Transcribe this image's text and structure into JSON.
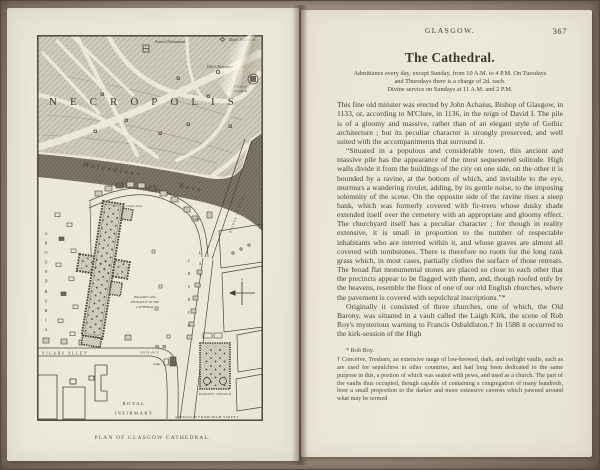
{
  "palette": {
    "backdrop": "#a29385",
    "page_cream": "#ebe7d8",
    "ink": "#45423a",
    "map_ink": "#4a463c",
    "burn_dark": "#7b7668"
  },
  "left_page": {
    "map": {
      "caption": "PLAN OF GLASGOW CATHEDRAL.",
      "necropolis": "NECROPOLIS",
      "burn_word1": "Molendinar",
      "burn_word2": "Burn",
      "knox_monument": "Knox's Monument",
      "black_monument": "Black's Monument",
      "dyke_monument": "Dyke's Monument",
      "mcgavin_line1": "M'Gavin's",
      "mcgavin_line2": "Monument",
      "bridge": "BRIDGE OF SIGHS",
      "church": "CHURCH",
      "lane": "LANE",
      "burial_word": "GROUND",
      "ground_word": "BURIAL",
      "vicars_alley": "VICARS ALLEY",
      "entrance": "ENTRANCE",
      "lodge1": "Lodge",
      "lodge2": "Lodge",
      "chapter_house": "Chapter house",
      "aisle_line1": "Blackadder's Aisle",
      "aisle_line2": "ENTRANCE TO THE",
      "aisle_line3": "CATHEDRAL",
      "royal1": "ROYAL",
      "royal2": "INFIRMARY",
      "barony": "BARONY CHURCH",
      "approach": "APPROACH FROM HIGH STREET",
      "compass_n": "N"
    }
  },
  "right_page": {
    "running_title": "GLASGOW.",
    "page_number": "367",
    "title": "The Cathedral.",
    "notice": [
      "Admittance every day, except Sunday, from 10 A.M. to 4 P.M.  On Tuesdays",
      "and Thursdays there is a charge of 2d. each.",
      "Divine service on Sundays at 11 A.M. and 2 P.M."
    ],
    "paragraphs": [
      "This fine old minster was erected by John Achaius, Bishop of Glasgow, in 1133, or, according to M'Clure, in 1136, in the reign of David I.  The pile is of a gloomy and massive, rather than of an elegant style of Gothic architecture ; but its peculiar character is strongly preserved, and well suited with the accompaniments that surround it.",
      "“Situated in a populous and considerable town, this ancient and massive pile has the appearance of the most sequestered solitude.  High walls divide it from the buildings of the city on one side, on the other it is bounded by a ravine, at the bottom of which, and invisible to the eye, murmurs a wandering rivulet, adding, by its gentle noise, to the imposing solemnity of the scene.  On the opposite side of the ravine rises a steep bank, which was formerly covered with fir-trees whose dusky shade extended itself over the cemetery with an appropriate and gloomy effect.  The churchyard itself has a peculiar character ; for though in reality extensive, it is small in proportion to the number of respectable inhabitants who are interred within it, and whose graves are almost all covered with tombstones.  There is therefore no room for the long rank grass which, in most cases, partially clothes the surface of those retreats.  The broad flat monumental stones are placed so close to each other that the precincts appear to be flagged with them, and, though roofed only by the heavens, resemble the floor of one of our old English churches, where the pavement is covered with sepulchral inscriptions.”*",
      "Originally it consisted of three churches, one of which, the Old Barony, was situated in a vault called the Laigh Kirk, the scene of Rob Roy's mysterious warning to Francis Osbaldiston.†  In 1588 it occurred to the kirk-session of the High"
    ],
    "footnotes": [
      "* Rob Roy.",
      "† Conceive, Tresham, an extensive range of low-browed, dark, and twilight vaults, such as are used for sepulchres in other countries, and had long been dedicated to the same purpose in this, a portion of which was seated with pews, and used as a church.  The part of the vaults thus occupied, though capable of containing a congregation of many hundreds, bore a small proportion to the darker and more extensive caverns which yawned around what may be termed"
    ]
  }
}
